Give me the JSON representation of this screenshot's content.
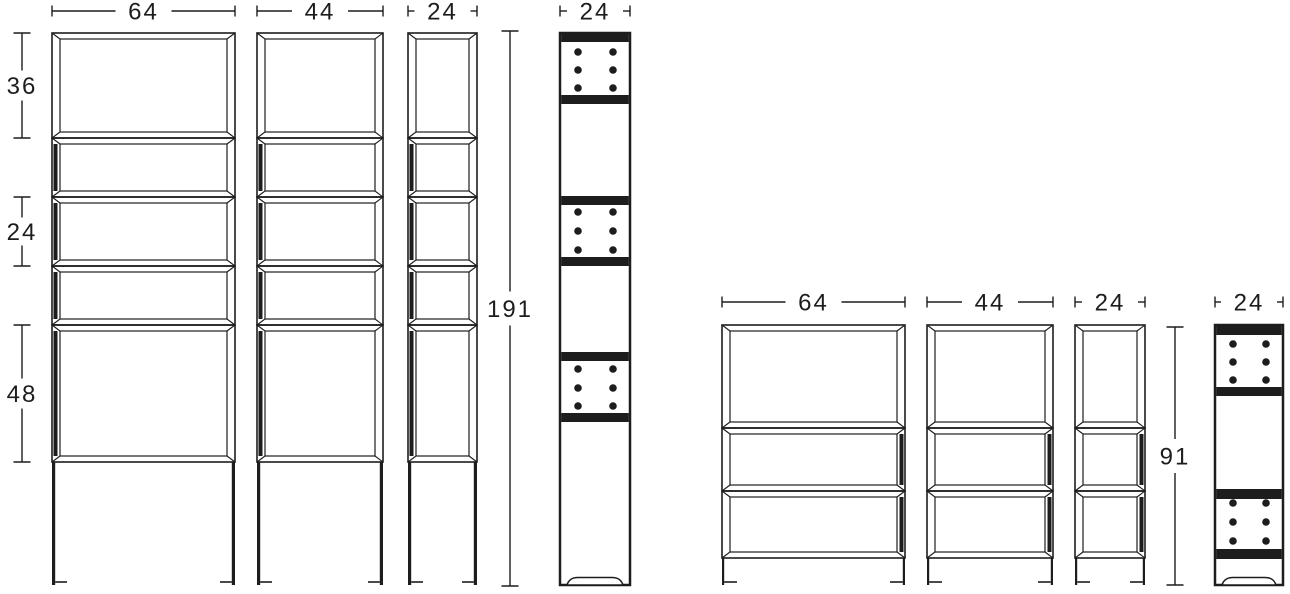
{
  "drawing": {
    "background_color": "#ffffff",
    "line_color": "#1d1d1d",
    "groups": [
      {
        "name": "tall-shelving",
        "height_label": "191",
        "opening_height_labels": [
          {
            "label": "36"
          },
          {
            "label": "24"
          },
          {
            "label": "48"
          }
        ],
        "units": [
          {
            "kind": "front-view",
            "width_label": "64"
          },
          {
            "kind": "front-view",
            "width_label": "44"
          },
          {
            "kind": "front-view",
            "width_label": "24"
          },
          {
            "kind": "side-view",
            "width_label": "24"
          }
        ]
      },
      {
        "name": "short-shelving",
        "height_label": "91",
        "units": [
          {
            "kind": "front-view",
            "width_label": "64"
          },
          {
            "kind": "front-view",
            "width_label": "44"
          },
          {
            "kind": "front-view",
            "width_label": "24"
          },
          {
            "kind": "side-view",
            "width_label": "24"
          }
        ]
      }
    ]
  }
}
